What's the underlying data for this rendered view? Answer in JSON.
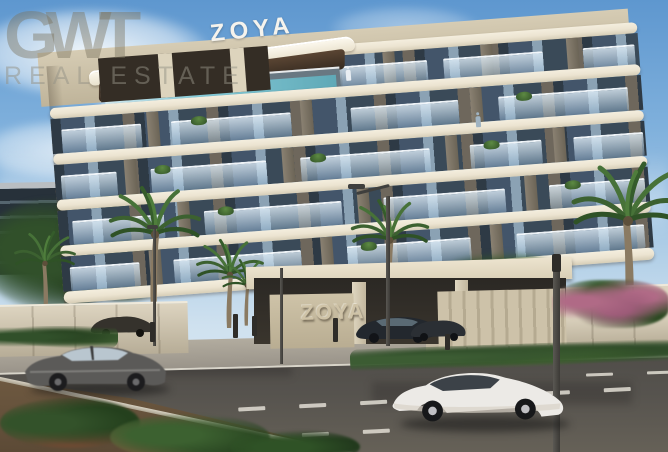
{
  "watermark": {
    "logo": "GWT",
    "subtitle": "REAL ESTATE"
  },
  "signs": {
    "rooftop": "ZOYA",
    "entrance": "ZOYA"
  },
  "colors": {
    "sky_top": "#5e97cf",
    "sky_horizon": "#cfe1ef",
    "slab": "#ece4d1",
    "glass_dark": "#43556a",
    "soffit": "#5a4533",
    "pool": "#17808f",
    "podium": "#d6ccb4",
    "stone_wall": "#cdc2a9",
    "sidewalk": "#b2ac9f",
    "road": "#56534e",
    "marking": "#ddd9cf",
    "flower_pink": "#b06a86",
    "palm_green": "#3c6130",
    "car_grey": "#5b5a58",
    "car_white": "#edece8",
    "watermark_tint": "#7c7560"
  }
}
